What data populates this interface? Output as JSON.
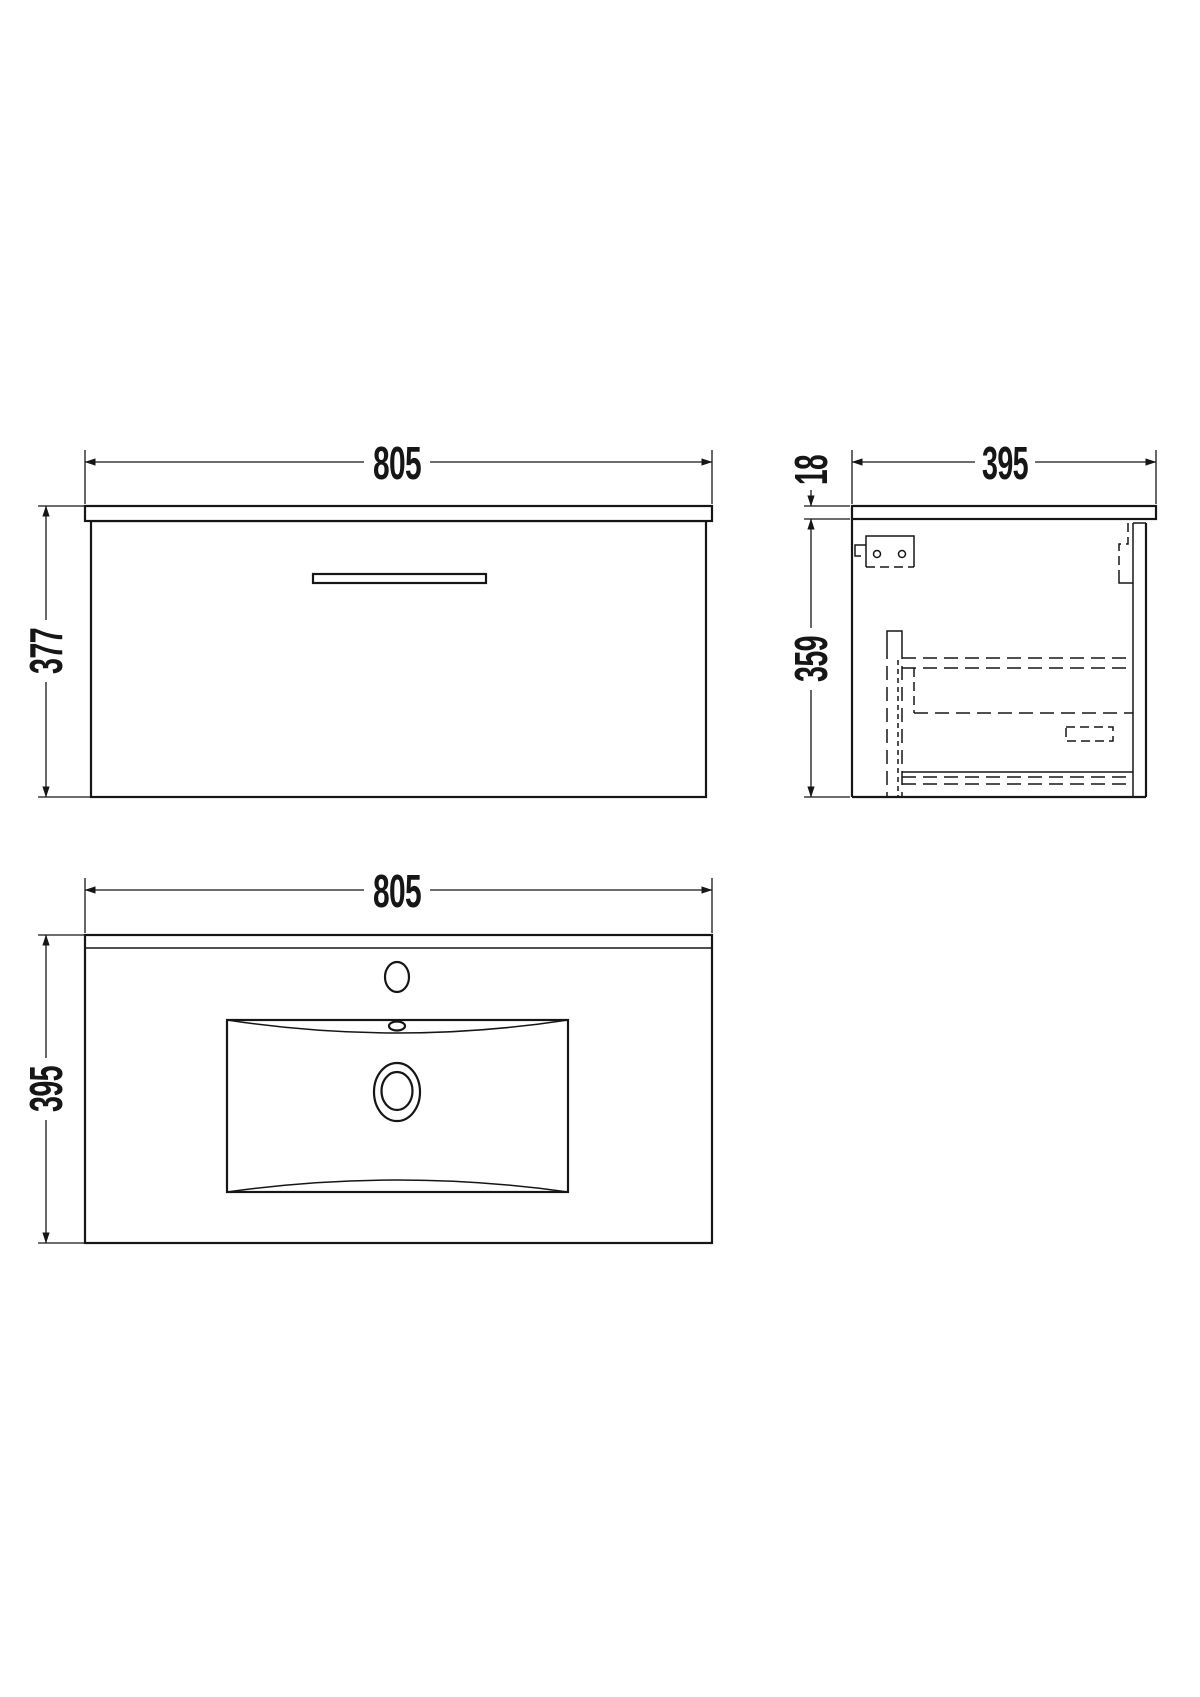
{
  "colors": {
    "background": "#ffffff",
    "line": "#161616"
  },
  "views": {
    "front_elevation": {
      "width_label": "805",
      "height_label": "377"
    },
    "side_section": {
      "depth_label": "395",
      "worktop_thickness_label": "18",
      "cabinet_height_label": "359"
    },
    "plan_basin": {
      "width_label": "805",
      "depth_label": "395"
    }
  }
}
